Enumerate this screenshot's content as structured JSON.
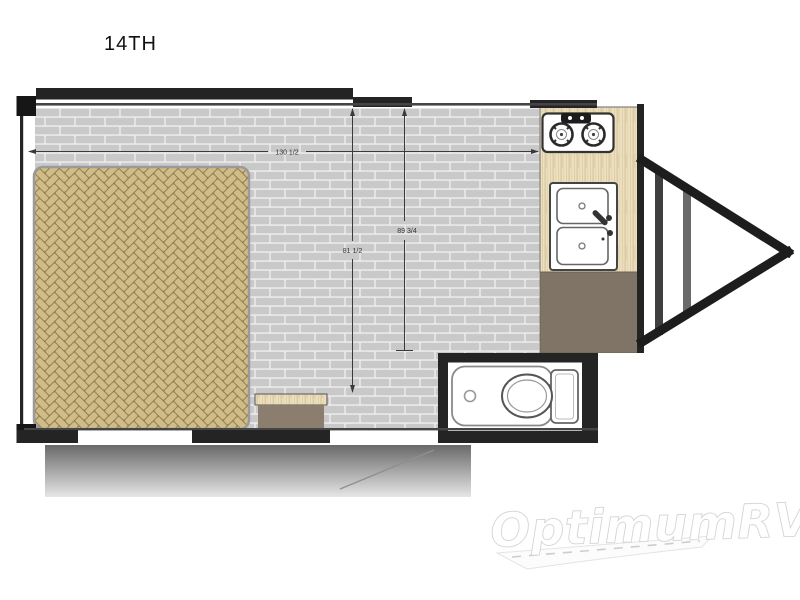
{
  "title": "14TH",
  "watermark": {
    "brand": "OptimumRV"
  },
  "dimensions": {
    "width": "130 1/2",
    "interior_left": "81 1/2",
    "interior_right": "89 3/4"
  },
  "features": {
    "bed": "herringbone floor mat / bed area",
    "stove": "two-burner cooktop",
    "sink": "double-basin sink",
    "toilet": "toilet compartment",
    "hitch": "a-frame tongue hitch",
    "ramp": "rear ramp door"
  },
  "colors": {
    "floor-brick": "#c9c9c9",
    "floor-mortar": "#e9e9e9",
    "bed-brick": "#d2bc86",
    "bed-gap": "#8d8059",
    "wood-base": "#ecdfbf",
    "wood-grain": "#d6c49a",
    "cabinet": "#7f7466",
    "step": "#8b7e6e",
    "wall": "#242424",
    "ramp-dark": "#696969",
    "ramp-light": "#e6e6e6"
  }
}
